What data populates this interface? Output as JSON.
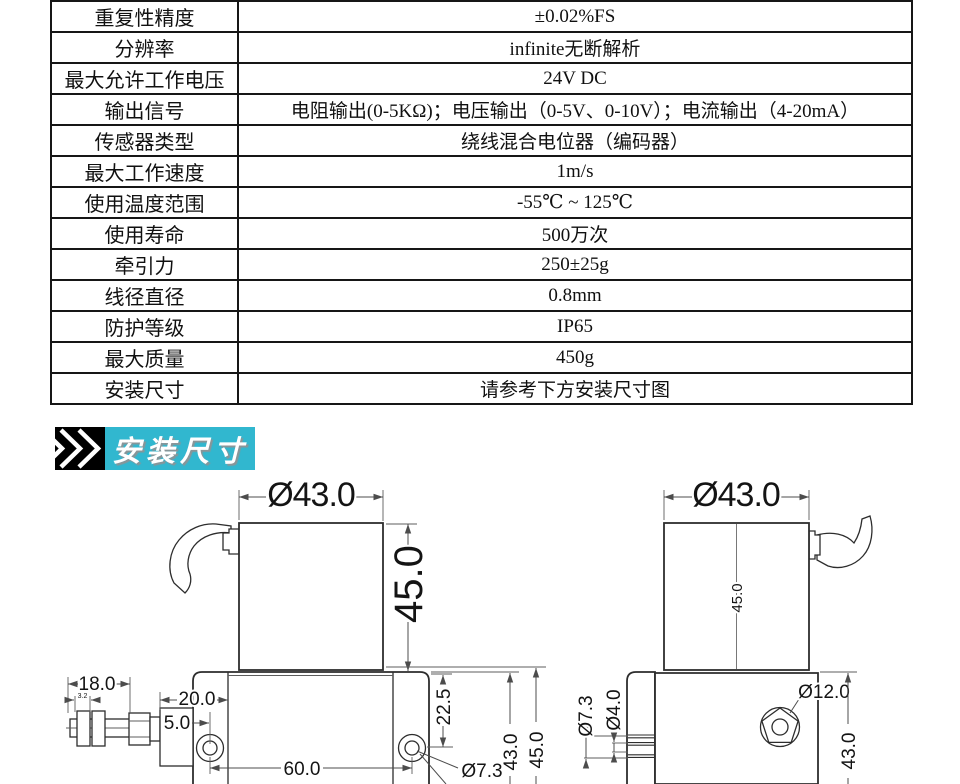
{
  "spec_table": {
    "rows": [
      {
        "label": "重复性精度",
        "value": "±0.02%FS"
      },
      {
        "label": "分辨率",
        "value": "infinite无断解析"
      },
      {
        "label": "最大允许工作电压",
        "value": "24V DC"
      },
      {
        "label": "输出信号",
        "value": "电阻输出(0-5KΩ)；电压输出（0-5V、0-10V）；电流输出（4-20mA）"
      },
      {
        "label": "传感器类型",
        "value": "绕线混合电位器（编码器）"
      },
      {
        "label": "最大工作速度",
        "value": "1m/s"
      },
      {
        "label": "使用温度范围",
        "value": "-55℃ ~ 125℃"
      },
      {
        "label": "使用寿命",
        "value": "500万次"
      },
      {
        "label": "牵引力",
        "value": "250±25g"
      },
      {
        "label": "线径直径",
        "value": "0.8mm"
      },
      {
        "label": "防护等级",
        "value": "IP65"
      },
      {
        "label": "最大质量",
        "value": "450g"
      },
      {
        "label": "安装尺寸",
        "value": "请参考下方安装尺寸图"
      }
    ]
  },
  "section_header": {
    "title": "安装尺寸",
    "accent_color": "#31b7cf",
    "icon": "double-chevron-icon"
  },
  "drawings": {
    "front_view": {
      "top_diameter": "Ø43.0",
      "body_height": "45.0",
      "fitting_length": "18.0",
      "fitting_small": "3.2",
      "bracket_width": "20.0",
      "hole_edge_offset": "5.0",
      "hole_spacing": "60.0",
      "hole_top_offset": "22.5",
      "base_height": "43.0",
      "base_total_height": "45.0",
      "hole_diameter": "Ø7.3"
    },
    "side_view": {
      "top_diameter": "Ø43.0",
      "body_height": "45.0",
      "outlet_outer_diameter": "Ø7.3",
      "outlet_inner_diameter": "Ø4.0",
      "boss_diameter": "Ø12.0",
      "base_height": "43.0"
    }
  }
}
